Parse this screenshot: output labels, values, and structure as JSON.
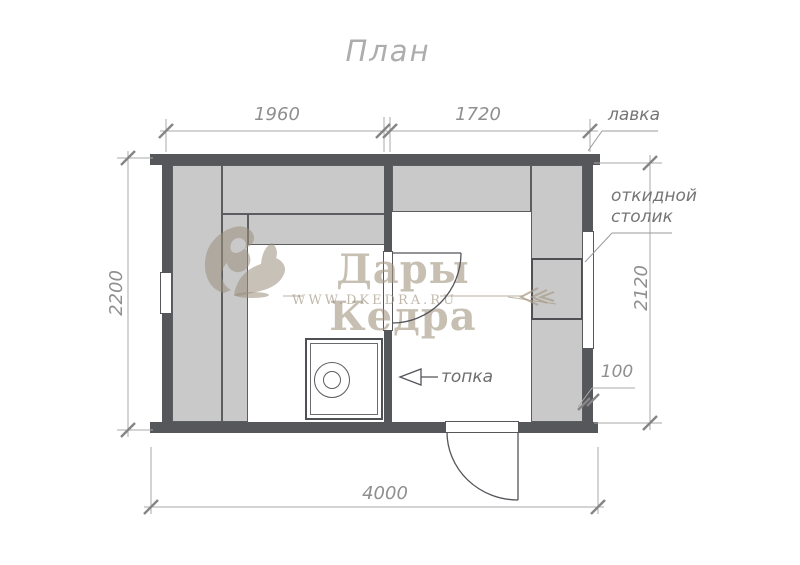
{
  "title": "План",
  "dimensions": {
    "top_left_span": "1960",
    "top_right_span": "1720",
    "left_side": "2200",
    "right_side": "2120",
    "bottom_total": "4000",
    "wall_thickness": "100"
  },
  "labels": {
    "bench": "лавка",
    "folding_table": "откидной столик",
    "firebox": "топка"
  },
  "watermark": {
    "brand": "Дары Кедра",
    "url": "WWW.DKEDRA.RU"
  },
  "icons": {
    "squirrel": "squirrel-logo-icon",
    "branch": "fir-branch-icon",
    "firebox_arrow": "left-arrow-icon",
    "doors": "door-swing-arc-icon",
    "stove": "stove-with-heater-icon"
  },
  "colors": {
    "wall": "#56575b",
    "bench_fill": "#c9c9ca",
    "dimension_text": "#8f8f8f",
    "watermark_beige": "#c9bfae",
    "background": "#ffffff"
  }
}
